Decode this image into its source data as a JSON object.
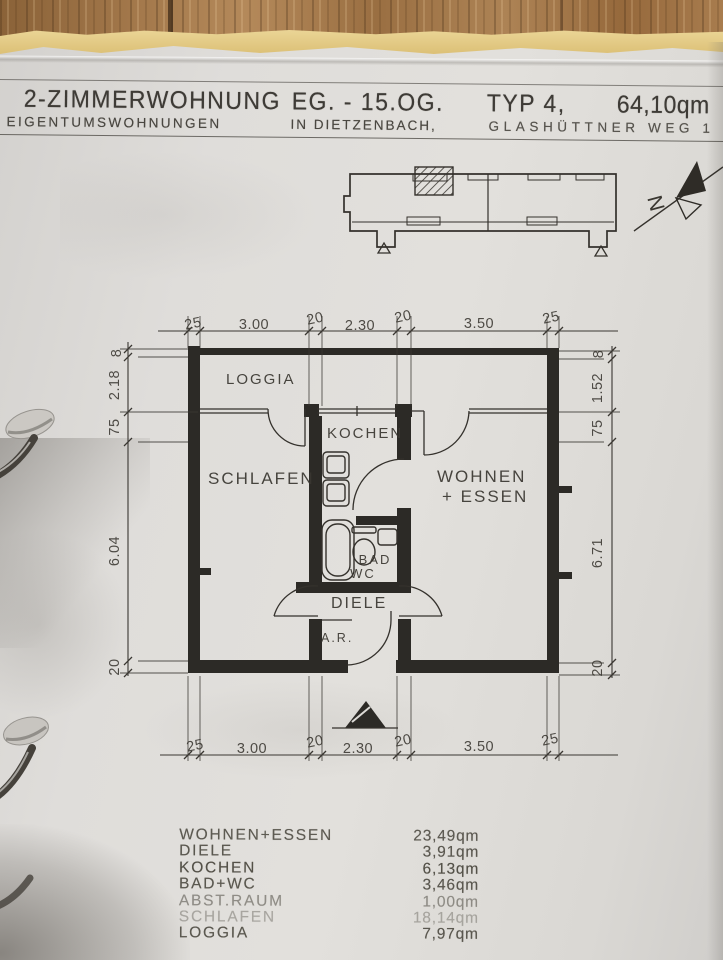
{
  "header": {
    "title": "2-ZIMMERWOHNUNG",
    "floors": "EG. - 15.OG.",
    "unit_type": "TYP 4,",
    "total_area": "64,10qm",
    "subtitle_left": "EIGENTUMSWOHNUNGEN",
    "subtitle_mid": "IN DIETZENBACH,",
    "subtitle_right": "GLASHÜTTNER WEG 1"
  },
  "site_plan": {
    "north_label": "N"
  },
  "floor_plan": {
    "rooms": {
      "loggia": "LOGGIA",
      "schlafen": "SCHLAFEN",
      "kochen": "KOCHEN",
      "wohnen_line1": "WOHNEN",
      "wohnen_line2": "+ ESSEN",
      "bad": "BAD",
      "wc": "WC",
      "diele": "DIELE",
      "abstellraum": "A.R."
    },
    "dims": {
      "top": [
        "25",
        "3.00",
        "20",
        "2.30",
        "20",
        "3.50",
        "25"
      ],
      "bottom": [
        "25",
        "3.00",
        "20",
        "2.30",
        "20",
        "3.50",
        "25"
      ],
      "left": [
        "8",
        "2.18",
        "75",
        "6.04",
        "20"
      ],
      "right": [
        "8",
        "1.52",
        "75",
        "6.71",
        "20"
      ]
    }
  },
  "area_table": {
    "rows": [
      {
        "label": "WOHNEN+ESSEN",
        "value": "23,49qm"
      },
      {
        "label": "DIELE",
        "value": "3,91qm"
      },
      {
        "label": "KOCHEN",
        "value": "6,13qm"
      },
      {
        "label": "BAD+WC",
        "value": "3,46qm"
      },
      {
        "label": "ABST.RAUM",
        "value": "1,00qm"
      },
      {
        "label": "SCHLAFEN",
        "value": "18,14qm"
      },
      {
        "label": "LOGGIA",
        "value": "7,97qm"
      }
    ]
  },
  "colors": {
    "ink": "#38352f",
    "paper": "#dedcd8",
    "wood": "#9b7045",
    "under_paper": "#e7d296"
  }
}
